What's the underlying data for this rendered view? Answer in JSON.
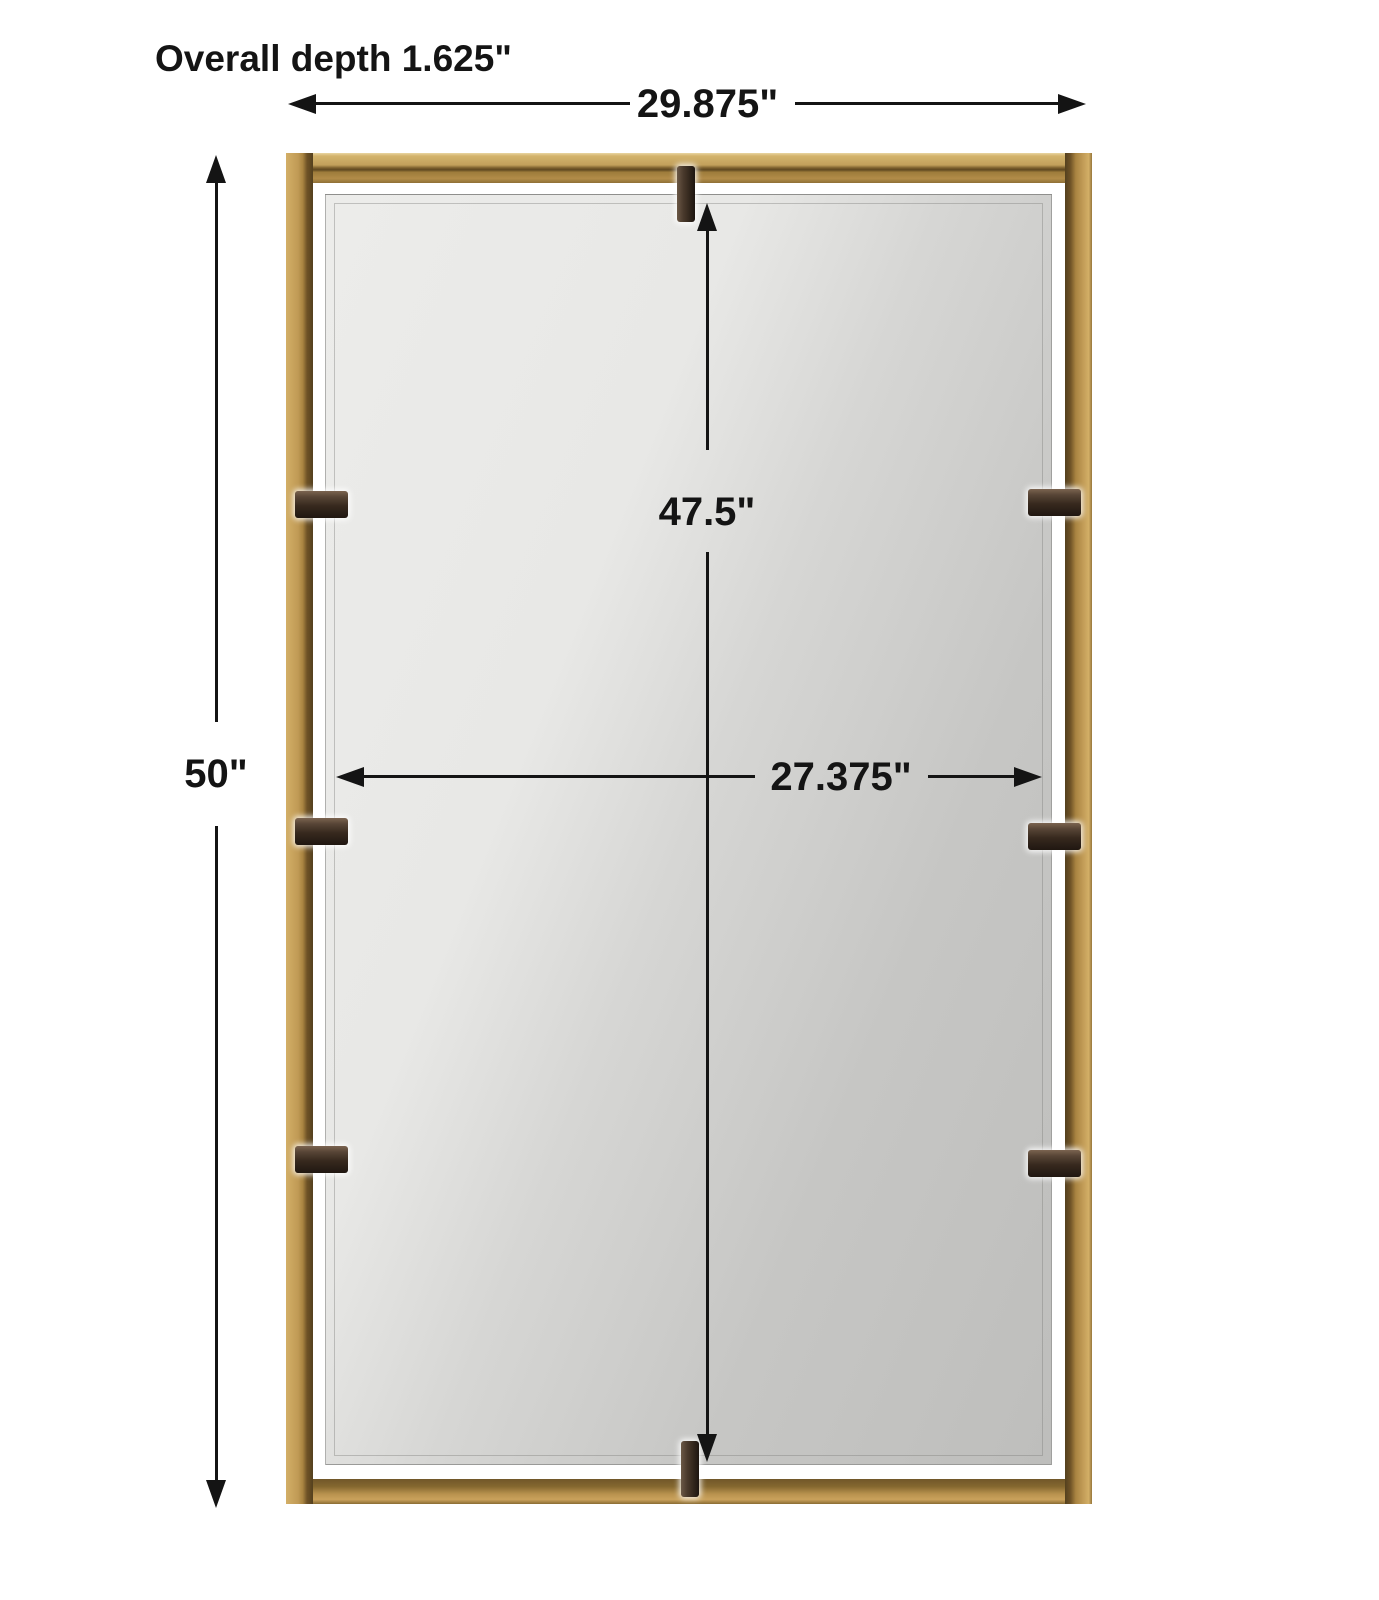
{
  "page": {
    "background": "#ffffff",
    "description": "Product dimension diagram of a rectangular wall mirror in a gold metal open frame held by dark bronze bracket clips"
  },
  "labels": {
    "overall_depth": "Overall depth 1.625\"",
    "overall_width": "29.875\"",
    "overall_height": "50\"",
    "mirror_height": "47.5\"",
    "mirror_width": "27.375\""
  },
  "colors": {
    "dimension_line": "#141414",
    "frame_gold": "#c09a55",
    "frame_gold_highlight": "#e9d6a2",
    "frame_gold_shadow": "#5f4821",
    "clip_bronze_dark": "#201711",
    "clip_bronze_light": "#7b6450",
    "mirror_glass_light": "#ececea",
    "mirror_glass_dark": "#bebebc"
  }
}
